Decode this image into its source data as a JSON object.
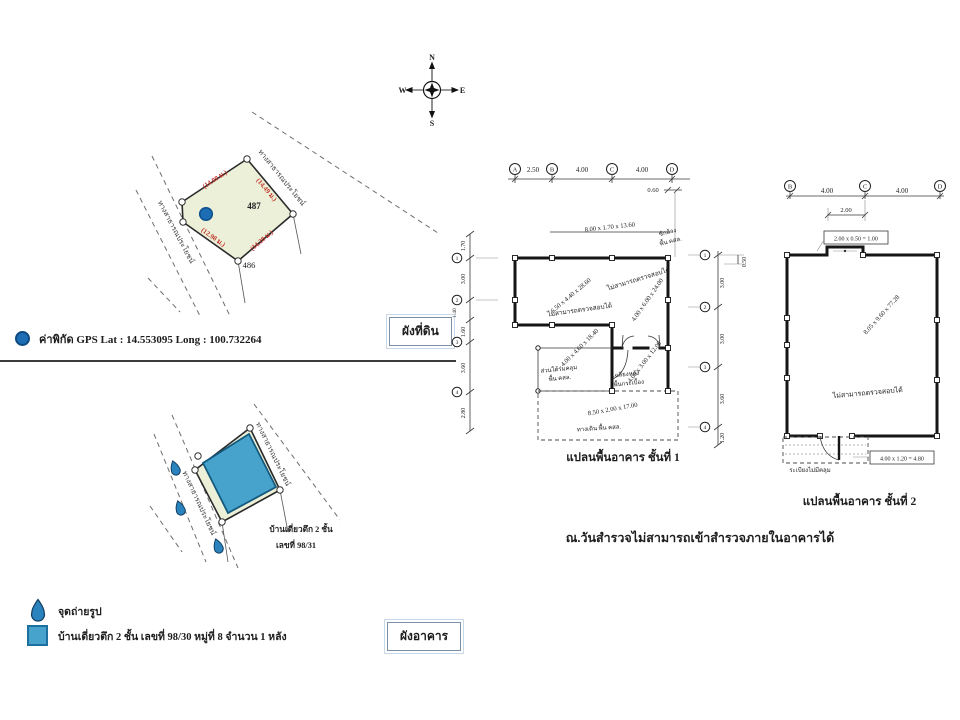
{
  "compass": {
    "n": "N",
    "e": "E",
    "s": "S",
    "w": "W"
  },
  "land_plan": {
    "tag": "ผังที่ดิน",
    "plot_no": "487",
    "neighbor_no": "486",
    "road_ne": "ทางสาธารณประโยชน์",
    "road_w": "ทางสาธารณประโยชน์",
    "dim_nw": "(14.00 ม.)",
    "dim_ne": "(14.49 ม.)",
    "dim_sw": "(12.98 ม.)",
    "dim_se": "(14.28 ม.)",
    "gps": "ค่าพิกัด GPS Lat : 14.553095 Long : 100.732264"
  },
  "building_plan": {
    "tag": "ผังอาคาร",
    "road_ne": "ทางสาธารณประโยชน์",
    "road_w": "ทางสาธารณประโยชน์",
    "house_line1": "บ้านเดี่ยวตึก 2 ชั้น",
    "house_line2": "เลขที่ 98/31"
  },
  "legend": {
    "photo_point": "จุดถ่ายรูป",
    "building": "บ้านเดี่ยวตึก 2 ชั้น เลขที่ 98/30 หมู่ที่ 8 จำนวน 1 หลัง"
  },
  "floor1": {
    "caption": "แปลนพื้นอาคาร ชั้นที่ 1",
    "grid": {
      "a": "A",
      "b": "B",
      "c": "C",
      "d": "D",
      "r1": "1",
      "r2": "2",
      "r3": "3",
      "r4": "4"
    },
    "dims": {
      "ab": "2.50",
      "bc": "4.00",
      "cd": "4.00",
      "off_right": "0.60",
      "l0": "1.70",
      "l1": "3.00",
      "l2": "1.40",
      "l3": "1.60",
      "l4": "3.60",
      "l5": "2.80",
      "r0": "0.50",
      "r1": "3.00",
      "r2": "3.00",
      "r3": "3.60",
      "r4": "1.20"
    },
    "wash_dim": "8.00 x 1.70 x 13.60",
    "wash_1": "ซักล้าง",
    "wash_2": "พื้น คสล.",
    "room1_dim": "6.50 x 4.40 x 28.60",
    "room1_note": "ไม่สามารถตรวจสอบได้",
    "room2_dim": "4.00 x 6.00 x 24.00",
    "room2_note": "ไม่สามารถตรวจสอบได้",
    "eave_dim": "4.00 x 4.60 x 18.40",
    "eave_1": "ส่วนใต้ร่มคลุม",
    "eave_2": "พื้น คสล.",
    "porch_dim": "4.00 x 3.00 x 12.00",
    "porch_1": "เฉลียงหลัง",
    "porch_2": "พื้นกระเบื้อง",
    "terrace_dim": "8.50 x 2.00 x 17.00",
    "terrace_label": "ทางเดิน พื้น คสล."
  },
  "floor2": {
    "caption": "แปลนพื้นอาคาร ชั้นที่ 2",
    "grid": {
      "b": "B",
      "c": "C",
      "d": "D"
    },
    "dims": {
      "bc": "4.00",
      "cd": "4.00",
      "c2": "2.00"
    },
    "canopy_calc": "2.00 x 0.50 = 1.00",
    "room_dim": "8.05 x 9.60 x 77.28",
    "room_note": "ไม่สามารถตรวจสอบได้",
    "balcony_calc": "4.00 x 1.20 = 4.80",
    "balcony_label": "ระเบียงไม่มีคลุม"
  },
  "survey_note": "ณ.วันสำรวจไม่สามารถเข้าสำรวจภายในอาคารได้",
  "colors": {
    "plot_fill": "#edf0d8",
    "building_blue": "#47a3cc",
    "dim_red": "#c1332b",
    "marker_blue": "#1c6db4"
  }
}
